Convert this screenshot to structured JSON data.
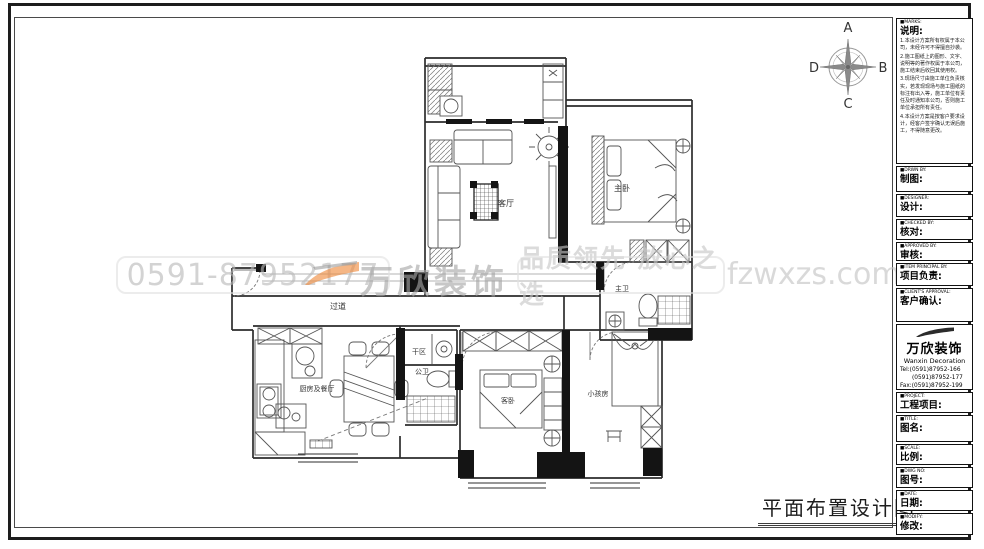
{
  "drawing_title": "平面布置设计图",
  "compass": {
    "n": "A",
    "e": "B",
    "s": "C",
    "w": "D"
  },
  "watermark": {
    "phone": "0591-87952177",
    "brand": "万欣装饰",
    "slogan": "品质领先 放心之选",
    "website": "fzwxzs.com",
    "orange": "#ef8a3c",
    "gray": "#bcbcbc"
  },
  "rooms": {
    "living": "客厅",
    "master": "主卧",
    "master_bath": "主卫",
    "corridor": "过道",
    "kitchen_dining": "厨房及餐厅",
    "dry_area": "干区",
    "bath": "公卫",
    "guest": "客卧",
    "kids": "小孩房"
  },
  "titleblock": {
    "marks_en": "■MARKS:",
    "marks_cn": "说明:",
    "notes": [
      "1.本设计方案所有权属于本公司，未经许可不得擅自抄袭。",
      "2.施工图纸上的图形、文字、说明等的著作权属于本公司，施工结束后收回其使用权。",
      "3.现场尺寸由施工单位负责核实，若发现现场与施工图纸的标注有出入等，施工单位有责任及时通知本公司，否则施工单位承担所有责任。",
      "4.本设计方案是按客户要求设计，经客户签字确认无误后施工，不得随意更改。"
    ],
    "fields": [
      {
        "en": "■DRWN BY:",
        "cn": "制图:"
      },
      {
        "en": "■DESIGNER:",
        "cn": "设计:"
      },
      {
        "en": "■CHECKED BY:",
        "cn": "核对:"
      },
      {
        "en": "■APPROVED BY:",
        "cn": "审核:"
      },
      {
        "en": "■ITEM PRINCIPAL BY:",
        "cn": "项目负责:"
      },
      {
        "en": "■CLIENT'S APPROVAL:",
        "cn": "客户确认:"
      }
    ],
    "company": {
      "name": "万欣装饰",
      "name_en": "Wanxin Decoration",
      "tel1": "Tel:(0591)87952-166",
      "tel2": "(0591)87952-177",
      "fax": "Fax:(0591)87952-199",
      "web": "Web:WWW.fzwxzs.com"
    },
    "fields2": [
      {
        "en": "■PROJECT:",
        "cn": "工程项目:"
      },
      {
        "en": "■TITLE:",
        "cn": "图名:"
      },
      {
        "en": "■SCALE:",
        "cn": "比例:"
      },
      {
        "en": "■DWG NO:",
        "cn": "图号:"
      },
      {
        "en": "■DATE:",
        "cn": "日期:"
      },
      {
        "en": "■MODIFY:",
        "cn": "修改:"
      }
    ]
  }
}
